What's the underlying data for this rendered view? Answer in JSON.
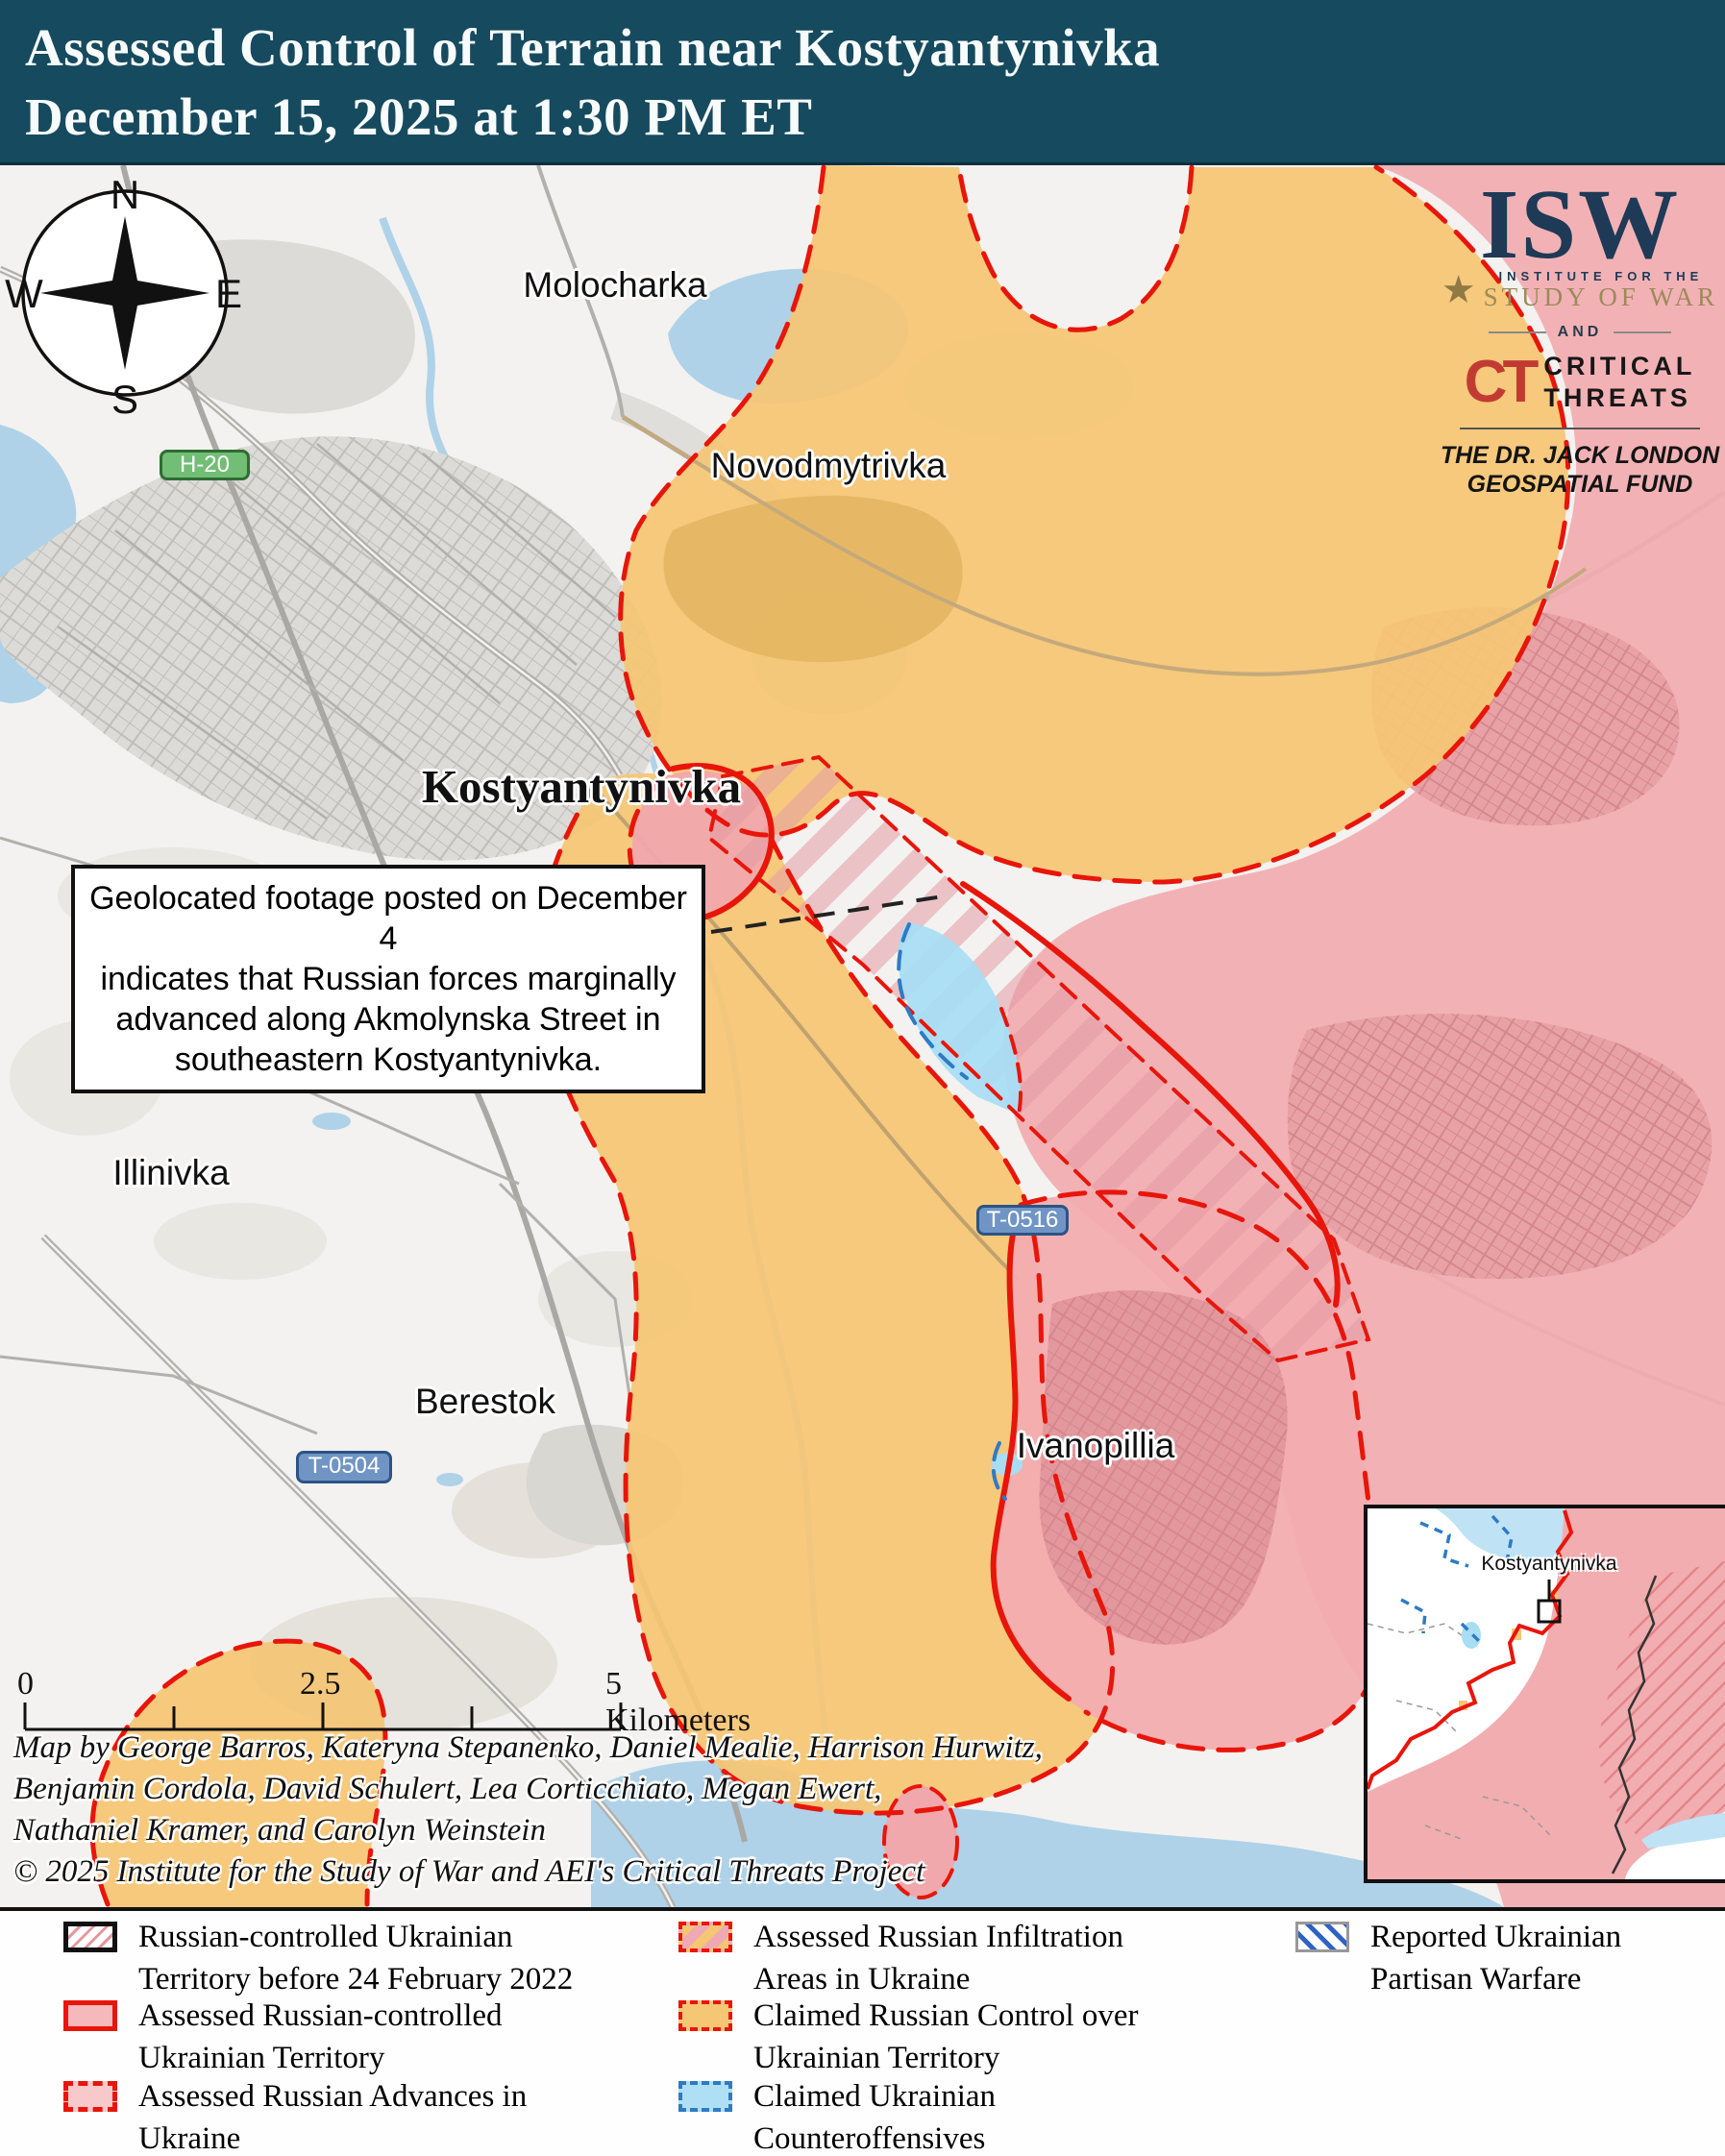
{
  "title": {
    "text": "Assessed Control of Terrain near Kostyantynivka\nDecember 15, 2025 at 1:30 PM ET"
  },
  "logo": {
    "isw": "ISW",
    "star": "★",
    "institute": "INSTITUTE FOR THE",
    "study": "STUDY OF WAR",
    "and": "AND",
    "ct": "CT",
    "critical_threats": "CRITICAL\nTHREATS",
    "fund": "THE DR. JACK LONDON\nGEOSPATIAL FUND"
  },
  "map": {
    "compass": {
      "n": "N",
      "e": "E",
      "s": "S",
      "w": "W"
    },
    "labels": {
      "molocharka": "Molocharka",
      "novodmytrivka": "Novodmytrivka",
      "kostyantynivka": "Kostyantynivka",
      "illinivka": "Illinivka",
      "berestok": "Berestok",
      "ivanopillia": "Ivanopillia"
    },
    "shields": {
      "h20": "H-20",
      "t0516": "T-0516",
      "t0504": "T-0504"
    },
    "callout": {
      "text": "Geolocated footage posted on December 4\nindicates that Russian forces marginally\nadvanced along Akmolynska Street in\nsoutheastern Kostyantynivka."
    },
    "scale": {
      "zero": "0",
      "mid": "2.5",
      "end": "5 Kilometers"
    },
    "credits": "Map by George Barros, Kateryna Stepanenko, Daniel Mealie, Harrison Hurwitz,\nBenjamin Cordola, David Schulert, Lea Corticchiato, Megan Ewert,\nNathaniel Kramer, and Carolyn Weinstein\n© 2025 Institute for the Study of War and AEI's Critical Threats Project",
    "inset": {
      "label": "Kostyantynivka"
    }
  },
  "legend": {
    "items": [
      {
        "label": "Russian-controlled Ukrainian\nTerritory before 24 February 2022",
        "swatch": "pre2022-hatch"
      },
      {
        "label": "Assessed Russian-controlled\nUkrainian Territory",
        "swatch": "red-solid-pink"
      },
      {
        "label": "Assessed Russian Advances in\nUkraine",
        "swatch": "red-dash-pink"
      },
      {
        "label": "Assessed Russian Infiltration\nAreas in Ukraine",
        "swatch": "red-dash-orange-stripes"
      },
      {
        "label": "Claimed Russian Control over\nUkrainian Territory",
        "swatch": "red-dash-orange"
      },
      {
        "label": "Claimed Ukrainian\nCounteroffensives",
        "swatch": "blue-dash-lightblue"
      },
      {
        "label": "Reported Ukrainian\nPartisan Warfare",
        "swatch": "blue-hatch"
      }
    ]
  },
  "colors": {
    "title_bg": "#164A5E",
    "claimed_russian_orange": "#F5C674",
    "assessed_russian_pink": "#F2ADB0",
    "counteroffensive_blue": "#A9DDF4",
    "frontline_red": "#E8150A",
    "ukrainian_dash_blue": "#2E7BC4",
    "water": "#AFD2E8",
    "urban_gray": "#DCDBD7",
    "isw_navy": "#1E3A56",
    "isw_gold": "#9C8A5A",
    "ct_red": "#C23B33"
  }
}
